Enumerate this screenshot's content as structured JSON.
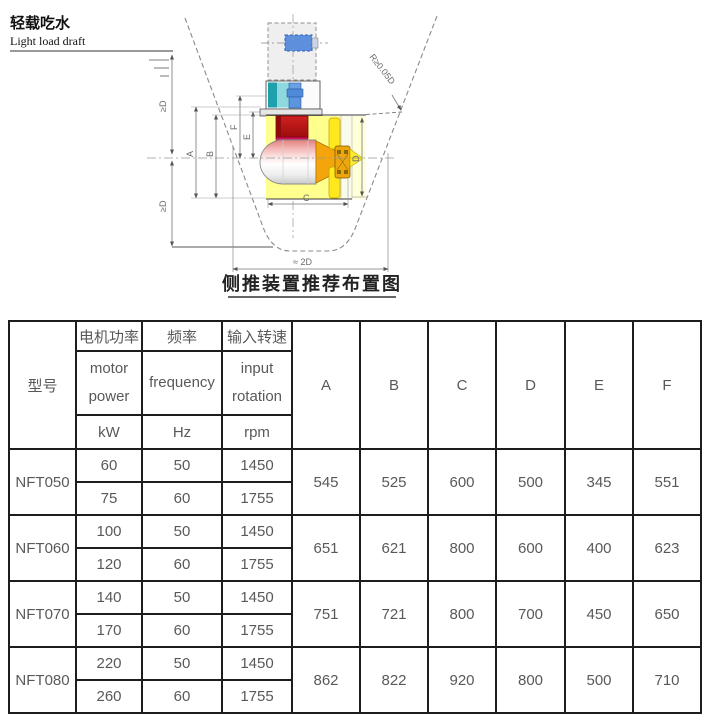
{
  "diagram": {
    "draft_label_zh": "轻载吃水",
    "draft_label_en": "Light load draft",
    "radius_note": "R≥0.05D",
    "clearance_upper": "≥D",
    "clearance_lower": "≥D",
    "width_note": "≈ 2D",
    "dims": {
      "A": "A",
      "B": "B",
      "C": "C",
      "D": "D",
      "E": "E",
      "F": "F"
    },
    "caption": "侧推装置推荐布置图",
    "colors": {
      "tunnel_yellow": "#ffff8e",
      "tunnel_pale": "#ffffd8",
      "gearbox_red": "#c01414",
      "gearbox_crimson": "#d42a66",
      "pod_pink": "#f2b3b1",
      "cone_orange": "#f4a50c",
      "propeller_yellow": "#ffe81e",
      "motor_teal": "#1fa0ad",
      "motor_blue": "#5c8fdd"
    }
  },
  "table": {
    "header": {
      "model": "型号",
      "cols": [
        {
          "zh": "电机功率",
          "en": "motor\npower",
          "unit": "kW"
        },
        {
          "zh": "频率",
          "en": "frequency",
          "unit": "Hz"
        },
        {
          "zh": "输入转速",
          "en": "input\nrotation",
          "unit": "rpm"
        }
      ],
      "dims": [
        "A",
        "B",
        "C",
        "D",
        "E",
        "F"
      ]
    },
    "rows": [
      {
        "model": "NFT050",
        "variants": [
          [
            "60",
            "50",
            "1450"
          ],
          [
            "75",
            "60",
            "1755"
          ]
        ],
        "dims": [
          "545",
          "525",
          "600",
          "500",
          "345",
          "551"
        ]
      },
      {
        "model": "NFT060",
        "variants": [
          [
            "100",
            "50",
            "1450"
          ],
          [
            "120",
            "60",
            "1755"
          ]
        ],
        "dims": [
          "651",
          "621",
          "800",
          "600",
          "400",
          "623"
        ]
      },
      {
        "model": "NFT070",
        "variants": [
          [
            "140",
            "50",
            "1450"
          ],
          [
            "170",
            "60",
            "1755"
          ]
        ],
        "dims": [
          "751",
          "721",
          "800",
          "700",
          "450",
          "650"
        ]
      },
      {
        "model": "NFT080",
        "variants": [
          [
            "220",
            "50",
            "1450"
          ],
          [
            "260",
            "60",
            "1755"
          ]
        ],
        "dims": [
          "862",
          "822",
          "920",
          "800",
          "500",
          "710"
        ]
      }
    ]
  }
}
